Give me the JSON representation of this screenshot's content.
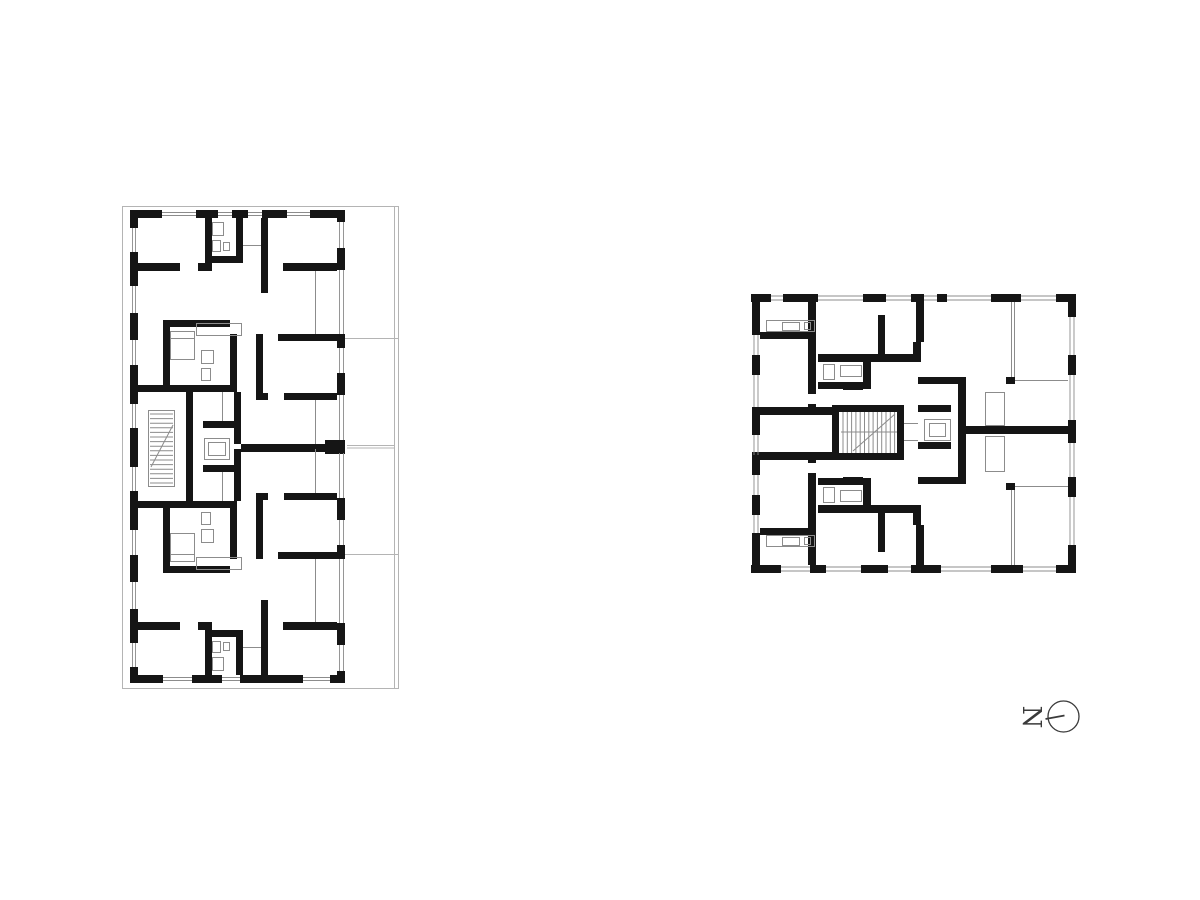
{
  "colors": {
    "background": "#ffffff",
    "wall": "#151515",
    "thin": "#8c8c8c",
    "boundary": "#b4b4b4",
    "arrow": "#3a3a3a"
  },
  "north_arrow": {
    "label": "N"
  }
}
